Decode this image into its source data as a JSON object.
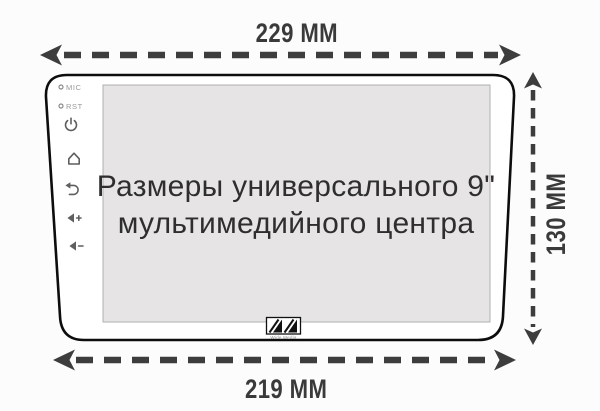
{
  "page": {
    "background": "#fcfcfc"
  },
  "title": {
    "line1": "Размеры универсального 9\"",
    "line2": "мультимедийного центра"
  },
  "dimensions": {
    "top_width": "229 ММ",
    "bottom_width": "219 ММ",
    "height": "130 ММ"
  },
  "device": {
    "side_controls": {
      "mic_label": "MIC",
      "rst_label": "RST",
      "icons": [
        "pinhole-mic",
        "pinhole-reset",
        "power",
        "home",
        "back",
        "volume-up",
        "volume-down"
      ]
    },
    "brand": "Wide Media"
  },
  "colors": {
    "arrow": "#3d3d3d",
    "outline": "#0d0d0d",
    "screen_fill": "#e6e4e4",
    "screen_border": "#b0b0b0",
    "title_text": "#2e2e2e",
    "dimension_text": "#3a3a3a",
    "side_label_text": "#9a9a9a",
    "icon": "#5f5f5f"
  }
}
